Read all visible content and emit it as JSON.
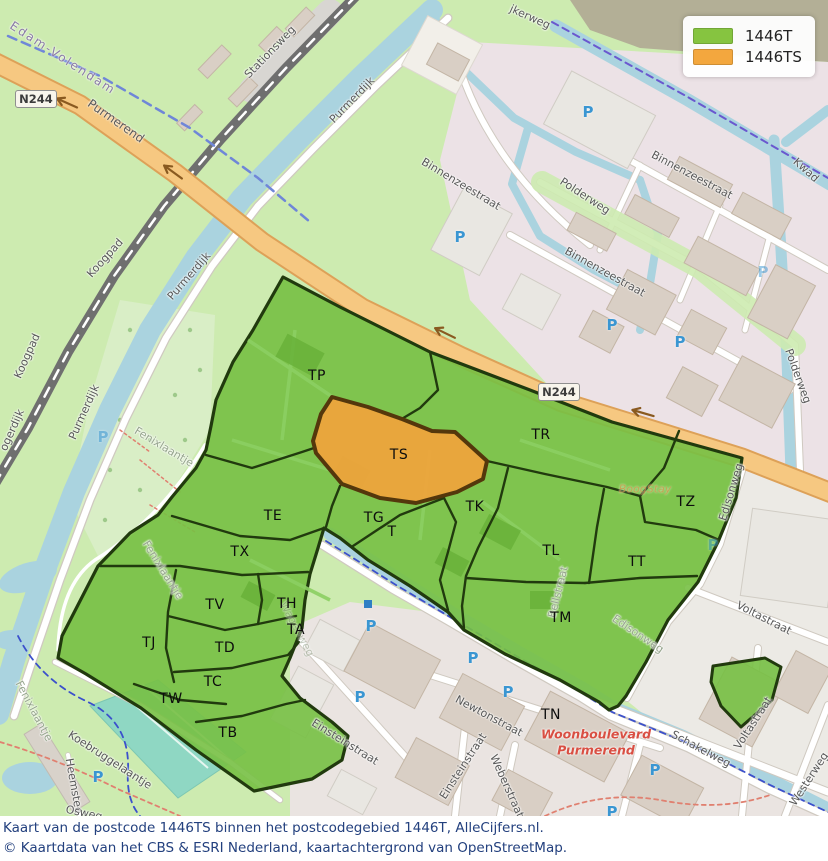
{
  "legend": {
    "items": [
      {
        "label": "1446T",
        "color": "#86c440"
      },
      {
        "label": "1446TS",
        "color": "#f3a73e"
      }
    ]
  },
  "caption": {
    "line1": "Kaart van de postcode 1446TS binnen het postcodegebied 1446T, AlleCijfers.nl.",
    "line2": "© Kaartdata van het CBS & ESRI Nederland, kaartachtergrond van OpenStreetMap."
  },
  "map": {
    "shields": [
      {
        "label": "N244"
      },
      {
        "label": "N244"
      }
    ],
    "regions": [
      {
        "code": "TP"
      },
      {
        "code": "TS"
      },
      {
        "code": "TR"
      },
      {
        "code": "TZ"
      },
      {
        "code": "TK"
      },
      {
        "code": "TE"
      },
      {
        "code": "TG"
      },
      {
        "code": "T"
      },
      {
        "code": "TL"
      },
      {
        "code": "TT"
      },
      {
        "code": "TX"
      },
      {
        "code": "TM"
      },
      {
        "code": "TV"
      },
      {
        "code": "TH"
      },
      {
        "code": "TA"
      },
      {
        "code": "TJ"
      },
      {
        "code": "TD"
      },
      {
        "code": "TC"
      },
      {
        "code": "TW"
      },
      {
        "code": "TB"
      },
      {
        "code": "TN"
      }
    ],
    "streets": [
      {
        "name": "Edam-Volendam"
      },
      {
        "name": "Purmerend"
      },
      {
        "name": "Stationsweg"
      },
      {
        "name": "jkerweg"
      },
      {
        "name": "Kwad"
      },
      {
        "name": "Purmerdijk"
      },
      {
        "name": "Purmerdijk"
      },
      {
        "name": "Purmerdijk"
      },
      {
        "name": "Koogpad"
      },
      {
        "name": "Koogpad"
      },
      {
        "name": "ogerdijk"
      },
      {
        "name": "Fenixlaantje"
      },
      {
        "name": "Fenixlaantje"
      },
      {
        "name": "Fenixlaantje"
      },
      {
        "name": "Binnenzeestraat"
      },
      {
        "name": "Binnenzeestraat"
      },
      {
        "name": "Binnenzeestraat"
      },
      {
        "name": "Polderweg"
      },
      {
        "name": "Polderweg"
      },
      {
        "name": "Edisonweg"
      },
      {
        "name": "Edisonweg"
      },
      {
        "name": "Bellstraat"
      },
      {
        "name": "Einsteinstraat"
      },
      {
        "name": "Einsteinstraat"
      },
      {
        "name": "Newtonstraat"
      },
      {
        "name": "Weberstraat"
      },
      {
        "name": "Schakelweg"
      },
      {
        "name": "Voltastraat"
      },
      {
        "name": "Voltastraat"
      },
      {
        "name": "Westerweg"
      },
      {
        "name": "Koebruggelaantje"
      },
      {
        "name": "Heemstee"
      },
      {
        "name": "Osweg"
      },
      {
        "name": "Wagenweg"
      }
    ],
    "poi": {
      "boogstay": "BoogStay",
      "woonboulevard_line1": "Woonboulevard",
      "woonboulevard_line2": "Purmerend"
    },
    "icons": {
      "parking_label": "P"
    },
    "colors": {
      "overlay_green": "#77c044",
      "overlay_green_border": "#213a0e",
      "overlay_orange": "#eea43c",
      "overlay_orange_border": "#54370c",
      "water": "#aad3df",
      "highway": "#f6c881",
      "parking_blue": "#3a96d2",
      "caption_text": "#23407e",
      "woonboulevard_red": "#d94f43"
    }
  }
}
